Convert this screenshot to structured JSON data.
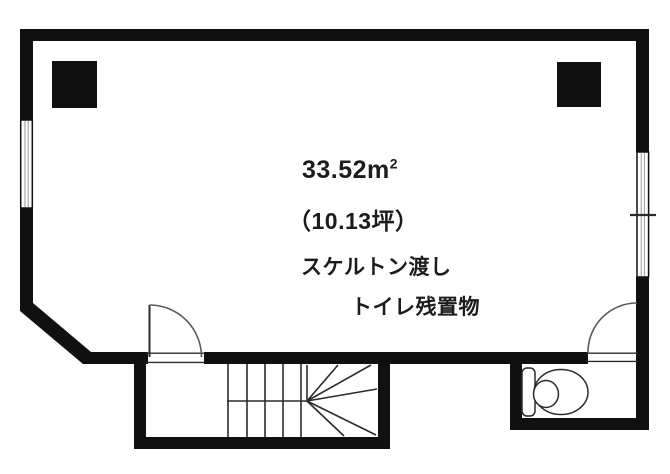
{
  "plan": {
    "area_sqm_base": "33.52m",
    "area_sqm_sup": "2",
    "area_tsubo": "（10.13坪）",
    "condition_note": "スケルトン渡し",
    "toilet_note": "トイレ残置物",
    "colors": {
      "wall": "#101010",
      "thin_line": "#2b2b2b",
      "arc_line": "#5a5a5a",
      "window_mullion": "#9a9a9a",
      "bg": "#ffffff"
    }
  }
}
